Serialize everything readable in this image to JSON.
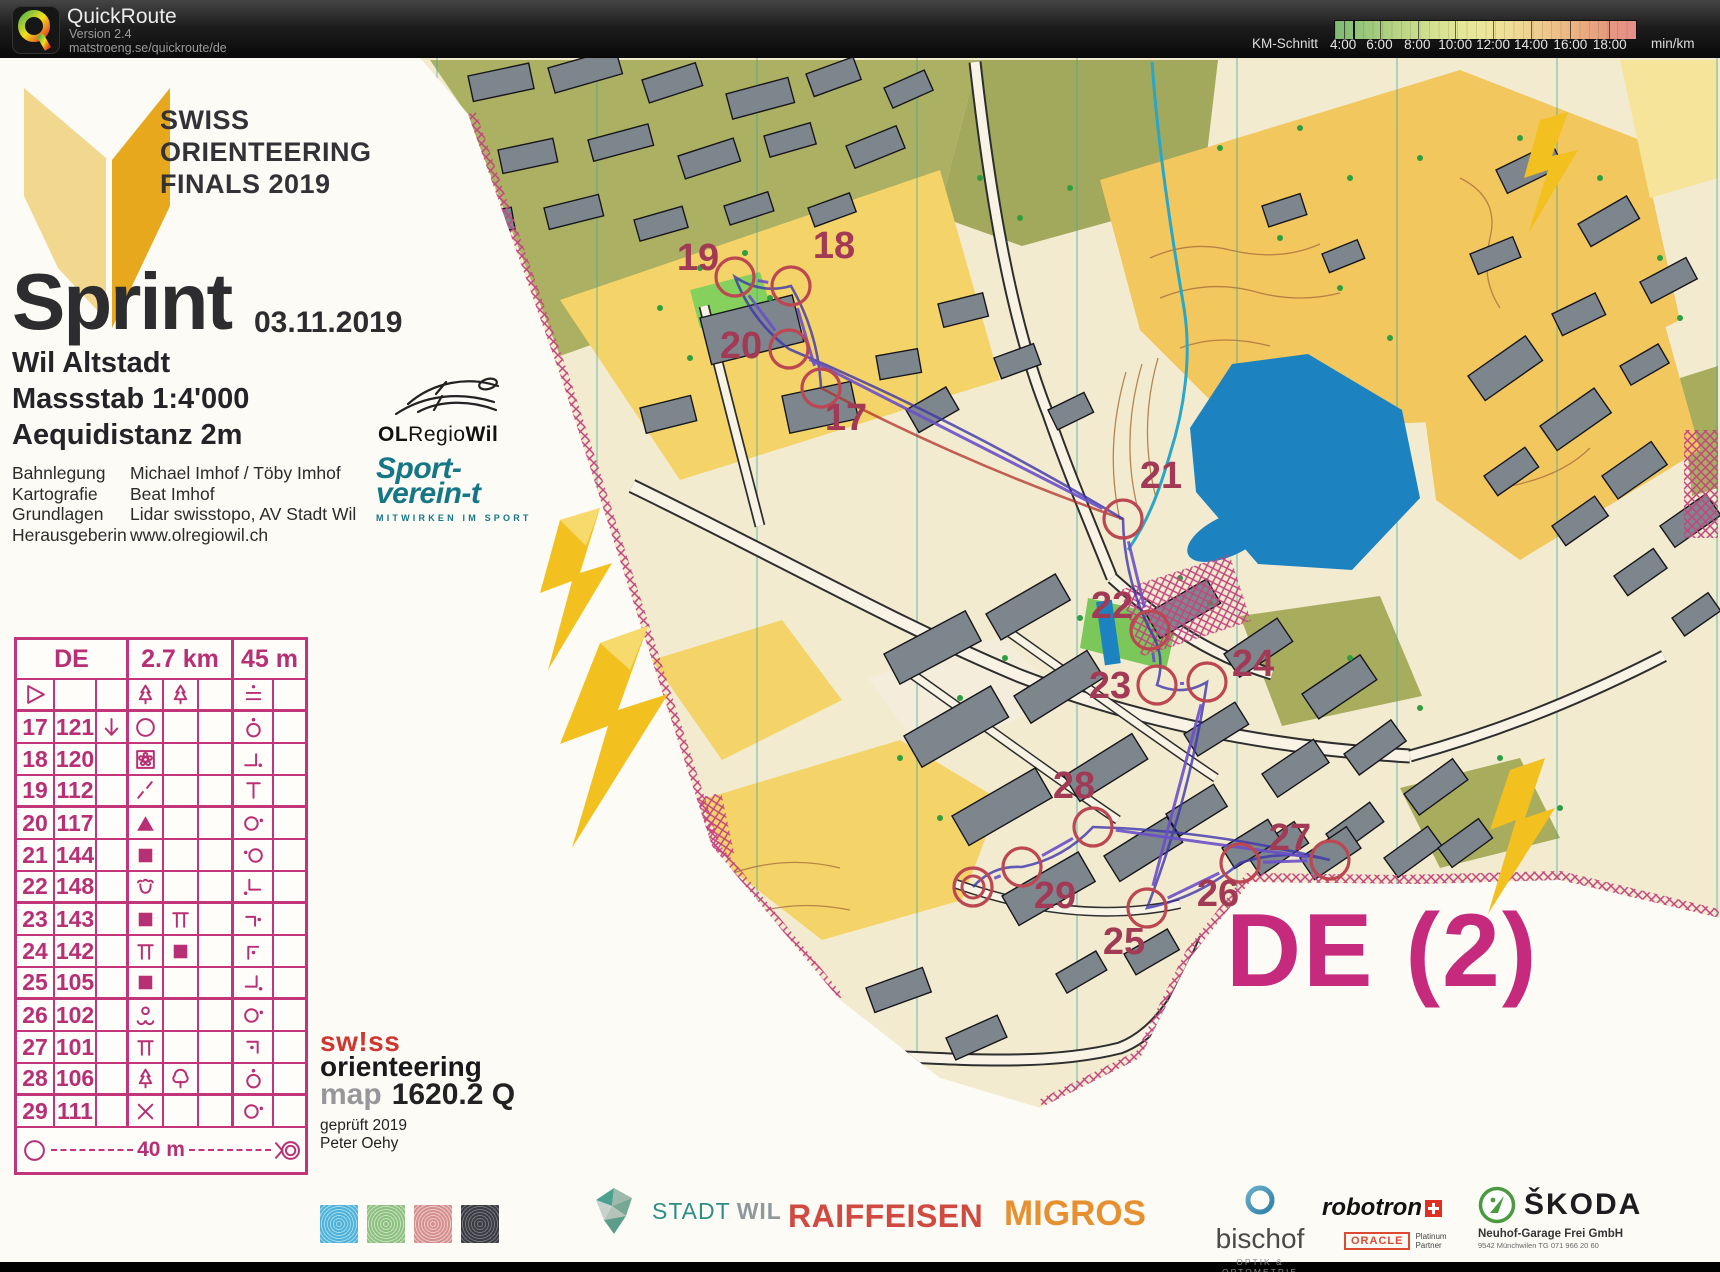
{
  "header": {
    "app_title": "QuickRoute",
    "version": "Version 2.4",
    "url": "matstroeng.se/quickroute/de",
    "legend": {
      "label": "KM-Schnitt",
      "unit": "min/km",
      "ticks": [
        {
          "label": "4:00",
          "pct": 3
        },
        {
          "label": "6:00",
          "pct": 15
        },
        {
          "label": "8:00",
          "pct": 27.5
        },
        {
          "label": "10:00",
          "pct": 40
        },
        {
          "label": "12:00",
          "pct": 52.5
        },
        {
          "label": "14:00",
          "pct": 65
        },
        {
          "label": "16:00",
          "pct": 78
        },
        {
          "label": "18:00",
          "pct": 91
        }
      ],
      "marker_pct": 6
    }
  },
  "map_info": {
    "event_lines": [
      "SWISS",
      "ORIENTEERING",
      "FINALS 2019"
    ],
    "race_title": "Sprint",
    "date": "03.11.2019",
    "location": "Wil Altstadt",
    "scale": "Massstab 1:4'000",
    "equidistance": "Aequidistanz 2m",
    "credits": [
      {
        "label": "Bahnlegung",
        "value": "Michael Imhof / Töby Imhof"
      },
      {
        "label": "Kartografie",
        "value": "Beat Imhof"
      },
      {
        "label": "Grundlagen",
        "value": "Lidar swisstopo, AV Stadt Wil"
      },
      {
        "label": "Herausgeberin",
        "value": "www.olregiowil.ch"
      }
    ],
    "club_name_parts": {
      "bold1": "OL",
      "mid": "Regio",
      "bold2": "Wil"
    },
    "sport_verein": {
      "line1": "Sport-",
      "line2": "verein-t",
      "tagline": "MITWIRKEN IM SPORT"
    }
  },
  "course_card": {
    "course": "DE",
    "length": "2.7 km",
    "climb": "45 m",
    "finish_text": "40 m",
    "rows": [
      {
        "a": "",
        "b": "",
        "c": "",
        "d": "spruce",
        "e": "spruce",
        "f": "",
        "g": "between",
        "h": "",
        "start": true
      },
      {
        "a": "17",
        "b": "121",
        "c": "arrow-down",
        "d": "circle",
        "e": "",
        "f": "",
        "g": "circle-dot-above",
        "h": ""
      },
      {
        "a": "18",
        "b": "120",
        "c": "",
        "d": "flower",
        "e": "",
        "f": "",
        "g": "corner-18",
        "h": ""
      },
      {
        "a": "19",
        "b": "112",
        "c": "",
        "d": "dashed-slash",
        "e": "",
        "f": "",
        "g": "tbar",
        "h": ""
      },
      {
        "a": "20",
        "b": "117",
        "c": "",
        "d": "triangle-filled",
        "e": "",
        "f": "",
        "g": "circle-dot-right",
        "h": ""
      },
      {
        "a": "21",
        "b": "144",
        "c": "",
        "d": "square-filled",
        "e": "",
        "f": "",
        "g": "dot-circle-left",
        "h": ""
      },
      {
        "a": "22",
        "b": "148",
        "c": "",
        "d": "fountain",
        "e": "",
        "f": "",
        "g": "corner-22",
        "h": ""
      },
      {
        "a": "23",
        "b": "143",
        "c": "",
        "d": "square-filled",
        "e": "pi",
        "f": "",
        "g": "corner-23",
        "h": ""
      },
      {
        "a": "24",
        "b": "142",
        "c": "",
        "d": "pi",
        "e": "square-filled",
        "f": "",
        "g": "corner-24",
        "h": ""
      },
      {
        "a": "25",
        "b": "105",
        "c": "",
        "d": "square-filled",
        "e": "",
        "f": "",
        "g": "corner-25",
        "h": ""
      },
      {
        "a": "26",
        "b": "102",
        "c": "",
        "d": "knolls",
        "e": "",
        "f": "",
        "g": "circle-dot-right",
        "h": ""
      },
      {
        "a": "27",
        "b": "101",
        "c": "",
        "d": "pi",
        "e": "",
        "f": "",
        "g": "corner-27",
        "h": ""
      },
      {
        "a": "28",
        "b": "106",
        "c": "",
        "d": "spruce",
        "e": "deciduous",
        "f": "",
        "g": "circle-dot-above",
        "h": ""
      },
      {
        "a": "29",
        "b": "111",
        "c": "",
        "d": "cross",
        "e": "",
        "f": "",
        "g": "circle-dot-right",
        "h": ""
      }
    ]
  },
  "map_course": {
    "controls": [
      {
        "n": "17",
        "x": 821,
        "y": 330,
        "lx": 846,
        "ly": 372
      },
      {
        "n": "18",
        "x": 791,
        "y": 228,
        "lx": 834,
        "ly": 200
      },
      {
        "n": "19",
        "x": 735,
        "y": 219,
        "lx": 698,
        "ly": 212
      },
      {
        "n": "20",
        "x": 789,
        "y": 291,
        "lx": 741,
        "ly": 300
      },
      {
        "n": "21",
        "x": 1123,
        "y": 461,
        "lx": 1161,
        "ly": 430
      },
      {
        "n": "22",
        "x": 1150,
        "y": 572,
        "lx": 1112,
        "ly": 560
      },
      {
        "n": "23",
        "x": 1157,
        "y": 627,
        "lx": 1110,
        "ly": 640
      },
      {
        "n": "24",
        "x": 1207,
        "y": 624,
        "lx": 1253,
        "ly": 618
      },
      {
        "n": "25",
        "x": 1147,
        "y": 850,
        "lx": 1124,
        "ly": 896
      },
      {
        "n": "26",
        "x": 1240,
        "y": 805,
        "lx": 1218,
        "ly": 848
      },
      {
        "n": "27",
        "x": 1330,
        "y": 802,
        "lx": 1290,
        "ly": 792
      },
      {
        "n": "28",
        "x": 1093,
        "y": 769,
        "lx": 1074,
        "ly": 740
      },
      {
        "n": "29",
        "x": 1022,
        "y": 809,
        "lx": 1055,
        "ly": 850
      }
    ],
    "finish": {
      "x": 973,
      "y": 829
    },
    "circle_radius": 19
  },
  "map_footer": {
    "swiss": "sw!ss",
    "orienteering": "orienteering",
    "map_label": "map",
    "map_number": "1620.2 Q",
    "checked": "geprüft 2019",
    "checker": "Peter Oehy"
  },
  "sponsors": {
    "stadtwil": {
      "part1": "STADT",
      "part2": "WIL"
    },
    "raiffeisen": "RAIFFEISEN",
    "migros": "MIGROS",
    "bischof": {
      "name": "bischof",
      "sub": "OPTIK & OPTOMETRIE"
    },
    "robotron": {
      "name": "robotron",
      "oracle": "ORACLE",
      "partner1": "Platinum",
      "partner2": "Partner"
    },
    "skoda": {
      "name": "ŠKODA",
      "sub1": "Neuhof-Garage Frei GmbH",
      "sub2": "9542 Münchwilen TG   071 966 20 60"
    }
  },
  "course_label": "DE (2)",
  "colors": {
    "accent_magenta": "#c52a7c",
    "card_line": "#c2357a",
    "control_number": "#a23a56",
    "control_circle": "#bc4752",
    "course_line": "#6b50c9",
    "gps_route": "#3d35ad",
    "lake_blue": "#1d83c0"
  }
}
